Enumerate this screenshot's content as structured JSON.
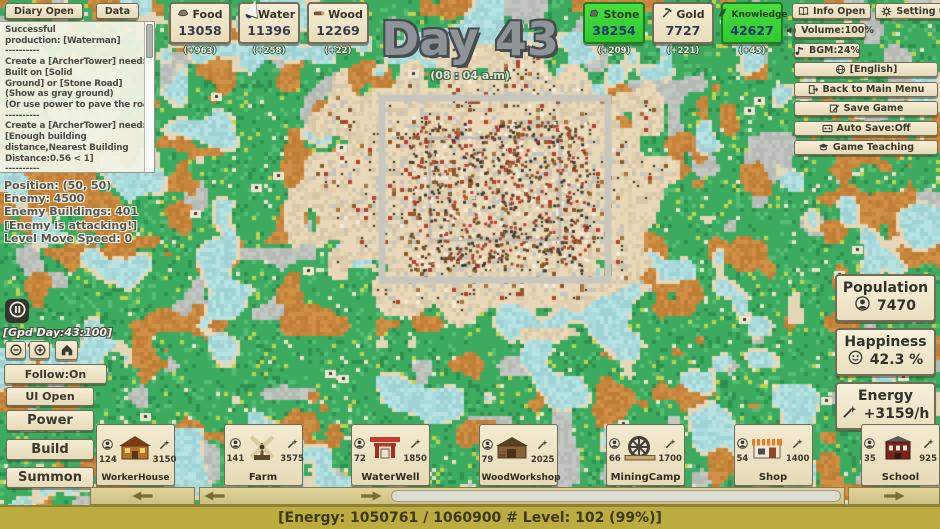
{
  "topLeft": {
    "diary_label": "Diary Open",
    "data_label": "Data"
  },
  "log": {
    "lines": [
      "Successful",
      "production: [Waterman]",
      "----------",
      "Create a [ArcherTower] need:",
      "Built on [Solid",
      "Ground] or [Stone Road]",
      "(Show as gray ground)",
      "(Or use power to pave the road)",
      "----------",
      "Create a [ArcherTower] need:",
      " [Enough building",
      "distance,Nearest Building",
      "Distance:0.56 < 1]",
      "----------"
    ]
  },
  "stats": {
    "lines": [
      "Position: (50,  50)",
      "Enemy: 4500",
      "Enemy Buildings: 401",
      "[Enemy is attacking!]",
      "Level Move Speed: 0"
    ]
  },
  "day": {
    "title": "Day 43",
    "time": "(08 : 04 a.m)"
  },
  "resources": {
    "left": [
      {
        "name": "Food",
        "value": "13058",
        "delta": "(+963)",
        "icon": "food-icon",
        "highlight": false
      },
      {
        "name": "Water",
        "value": "11396",
        "delta": "(+258)",
        "icon": "water-icon",
        "highlight": false
      },
      {
        "name": "Wood",
        "value": "12269",
        "delta": "(+22)",
        "icon": "wood-icon",
        "highlight": false
      }
    ],
    "right": [
      {
        "name": "Stone",
        "value": "38254",
        "delta": "(+209)",
        "icon": "stone-icon",
        "highlight": true
      },
      {
        "name": "Gold",
        "value": "7727",
        "delta": "(+221)",
        "icon": "gold-icon",
        "highlight": false
      },
      {
        "name": "Knowledge",
        "value": "42627",
        "delta": "(+45)",
        "icon": "knowledge-icon",
        "highlight": true
      }
    ]
  },
  "rightMenu": {
    "topRow": [
      {
        "label": "Info Open",
        "icon": "info-icon"
      },
      {
        "label": "Setting Open",
        "icon": "gear-icon"
      }
    ],
    "items": [
      {
        "label": "Volume:100%",
        "icon": "volume-icon"
      },
      {
        "label": "BGM:24%",
        "icon": "music-note-icon"
      },
      {
        "label": "[English]",
        "icon": "language-icon"
      },
      {
        "label": "Back to Main Menu",
        "icon": "exit-icon"
      },
      {
        "label": "Save Game",
        "icon": "save-icon"
      },
      {
        "label": "Auto Save:Off",
        "icon": "autosave-icon"
      },
      {
        "label": "Game Teaching",
        "icon": "teaching-icon"
      }
    ]
  },
  "statusBoxes": {
    "population": {
      "label": "Population",
      "value": "7470",
      "icon": "person-icon"
    },
    "happiness": {
      "label": "Happiness",
      "value": "42.3 %",
      "icon": "smiley-icon"
    },
    "energy": {
      "label": "Energy",
      "value": "+3159/h",
      "icon": "wand-icon"
    }
  },
  "leftControls": {
    "god_text": "[Gpd Day:43:100]",
    "follow_label": "Follow:On",
    "ui_label": "UI Open",
    "power_label": "Power",
    "build_label": "Build",
    "summon_label": "Summon"
  },
  "buildings": [
    {
      "name": "WorkerHouse",
      "count": "124",
      "cost": "3150"
    },
    {
      "name": "Farm",
      "count": "141",
      "cost": "3575"
    },
    {
      "name": "WaterWell",
      "count": "72",
      "cost": "1850"
    },
    {
      "name": "WoodWorkshop",
      "count": "79",
      "cost": "2025"
    },
    {
      "name": "MiningCamp",
      "count": "66",
      "cost": "1700"
    },
    {
      "name": "Shop",
      "count": "54",
      "cost": "1400"
    },
    {
      "name": "School",
      "count": "35",
      "cost": "925"
    }
  ],
  "bottomBar": {
    "text": "[Energy: 1050761 / 1060900 # Level: 102 (99%)]"
  },
  "colors": {
    "ui_tan": "#ece2c2",
    "highlight_green": "#35d435",
    "grass": "#3cab60",
    "dirt": "#c8863c",
    "water": "#a9dbdc",
    "stone_gray": "#b6bab4",
    "city_sand": "#ead9b8",
    "bottom_bar": "#bcab3e"
  }
}
